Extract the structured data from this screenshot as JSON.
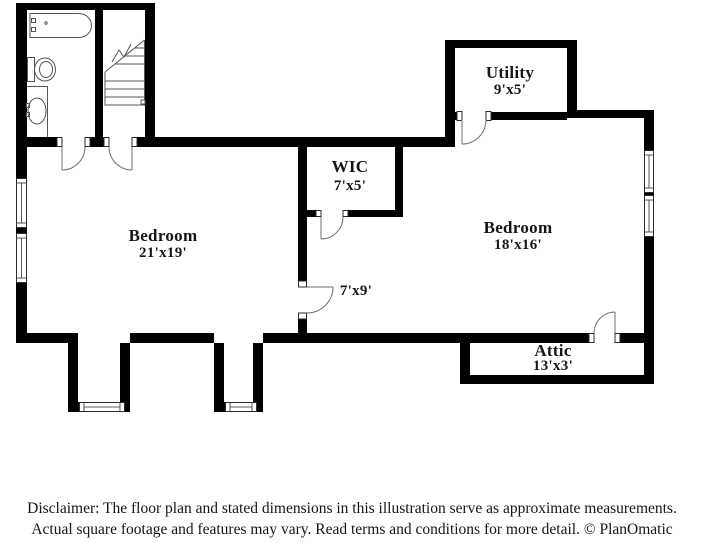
{
  "rooms": {
    "bedroom_left": {
      "name": "Bedroom",
      "dims": "21'x19'"
    },
    "wic": {
      "name": "WIC",
      "dims": "7'x5'"
    },
    "utility": {
      "name": "Utility",
      "dims": "9'x5'"
    },
    "bedroom_right": {
      "name": "Bedroom",
      "dims": "18'x16'"
    },
    "attic": {
      "name": "Attic",
      "dims": "13'x3'"
    },
    "hallway": {
      "dims": "7'x9'"
    }
  },
  "disclaimer": {
    "line1": "Disclaimer: The floor plan and stated dimensions in this illustration serve as approximate measurements.",
    "line2": "Actual square footage and features may vary. Read terms and conditions for more detail. © PlanOmatic"
  },
  "colors": {
    "wall": "#000000",
    "text": "#151515",
    "background": "#ffffff"
  }
}
